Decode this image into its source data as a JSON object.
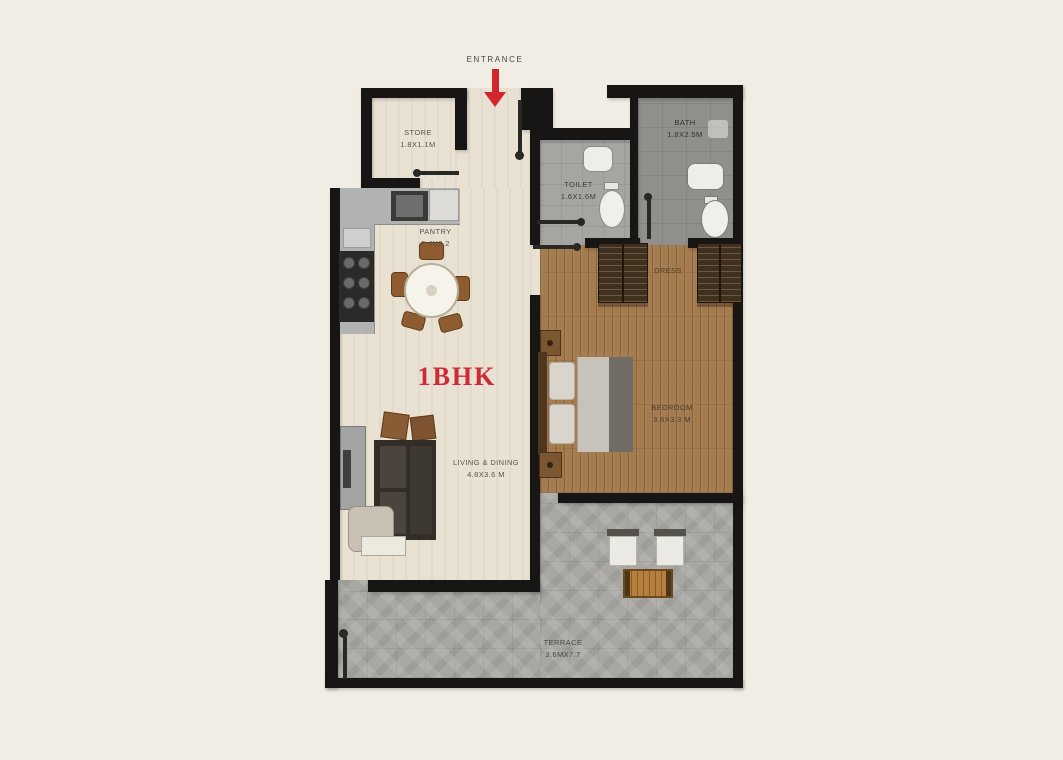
{
  "title": "1BHK",
  "entrance_label": "ENTRANCE",
  "rooms": {
    "store": {
      "name": "STORE",
      "dims": "1.8X1.1M"
    },
    "pantry": {
      "name": "PANTRY",
      "dims": "2.4X2.2"
    },
    "toilet": {
      "name": "TOILET",
      "dims": "1.6X1.6M"
    },
    "bath": {
      "name": "BATH",
      "dims": "1.8X2.5M"
    },
    "dress": {
      "name": "DRESS"
    },
    "bedroom": {
      "name": "BEDROOM",
      "dims": "3.6X3.3 M"
    },
    "living": {
      "name": "LIVING & DINING",
      "dims": "4.8X3.6 M"
    },
    "terrace": {
      "name": "TERRACE",
      "dims": "3.6MX7.7"
    }
  },
  "colors": {
    "background": "#f2ede4",
    "wall": "#181614",
    "accent_red": "#d2262e",
    "title_red": "#ce2936",
    "floor_beige": "#e9e2d3",
    "floor_wood": "#a57c50",
    "floor_stone": "#a8a7a4",
    "floor_toilet": "#a7a5a2",
    "floor_bath": "#908f8c"
  }
}
